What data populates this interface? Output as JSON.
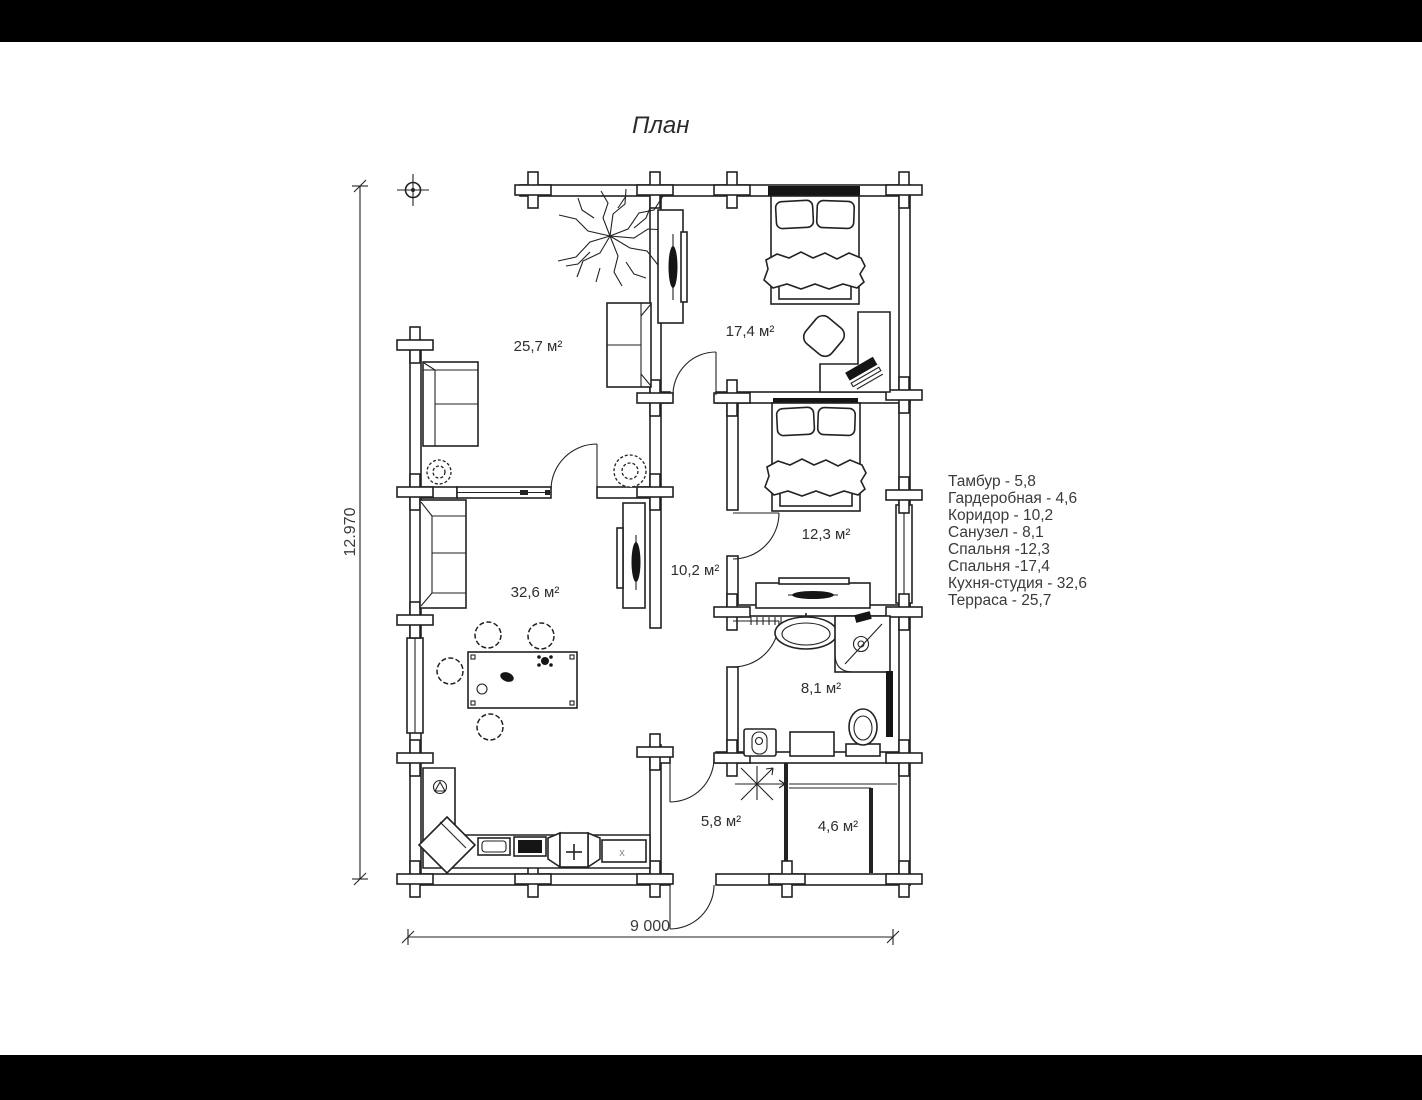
{
  "title": "План",
  "legend": {
    "items": [
      "Тамбур - 5,8",
      "Гардеробная - 4,6",
      "Коридор - 10,2",
      "Санузел - 8,1",
      "Спальня -12,3",
      "Спальня -17,4",
      "Кухня-студия - 32,6",
      "Терраса - 25,7"
    ]
  },
  "dimensions": {
    "height": "12.970",
    "width": "9 000"
  },
  "room_labels": {
    "terrace": "25,7 м²",
    "bedroom_large": "17,4 м²",
    "bedroom_small": "12,3 м²",
    "corridor": "10,2 м²",
    "kitchen_studio": "32,6 м²",
    "bathroom": "8,1 м²",
    "tambour": "5,8 м²",
    "wardrobe": "4,6 м²"
  },
  "annotations": {
    "appliance_mark": "x"
  },
  "colors": {
    "line": "#222222",
    "background": "#ffffff",
    "letterbox": "#000000"
  }
}
